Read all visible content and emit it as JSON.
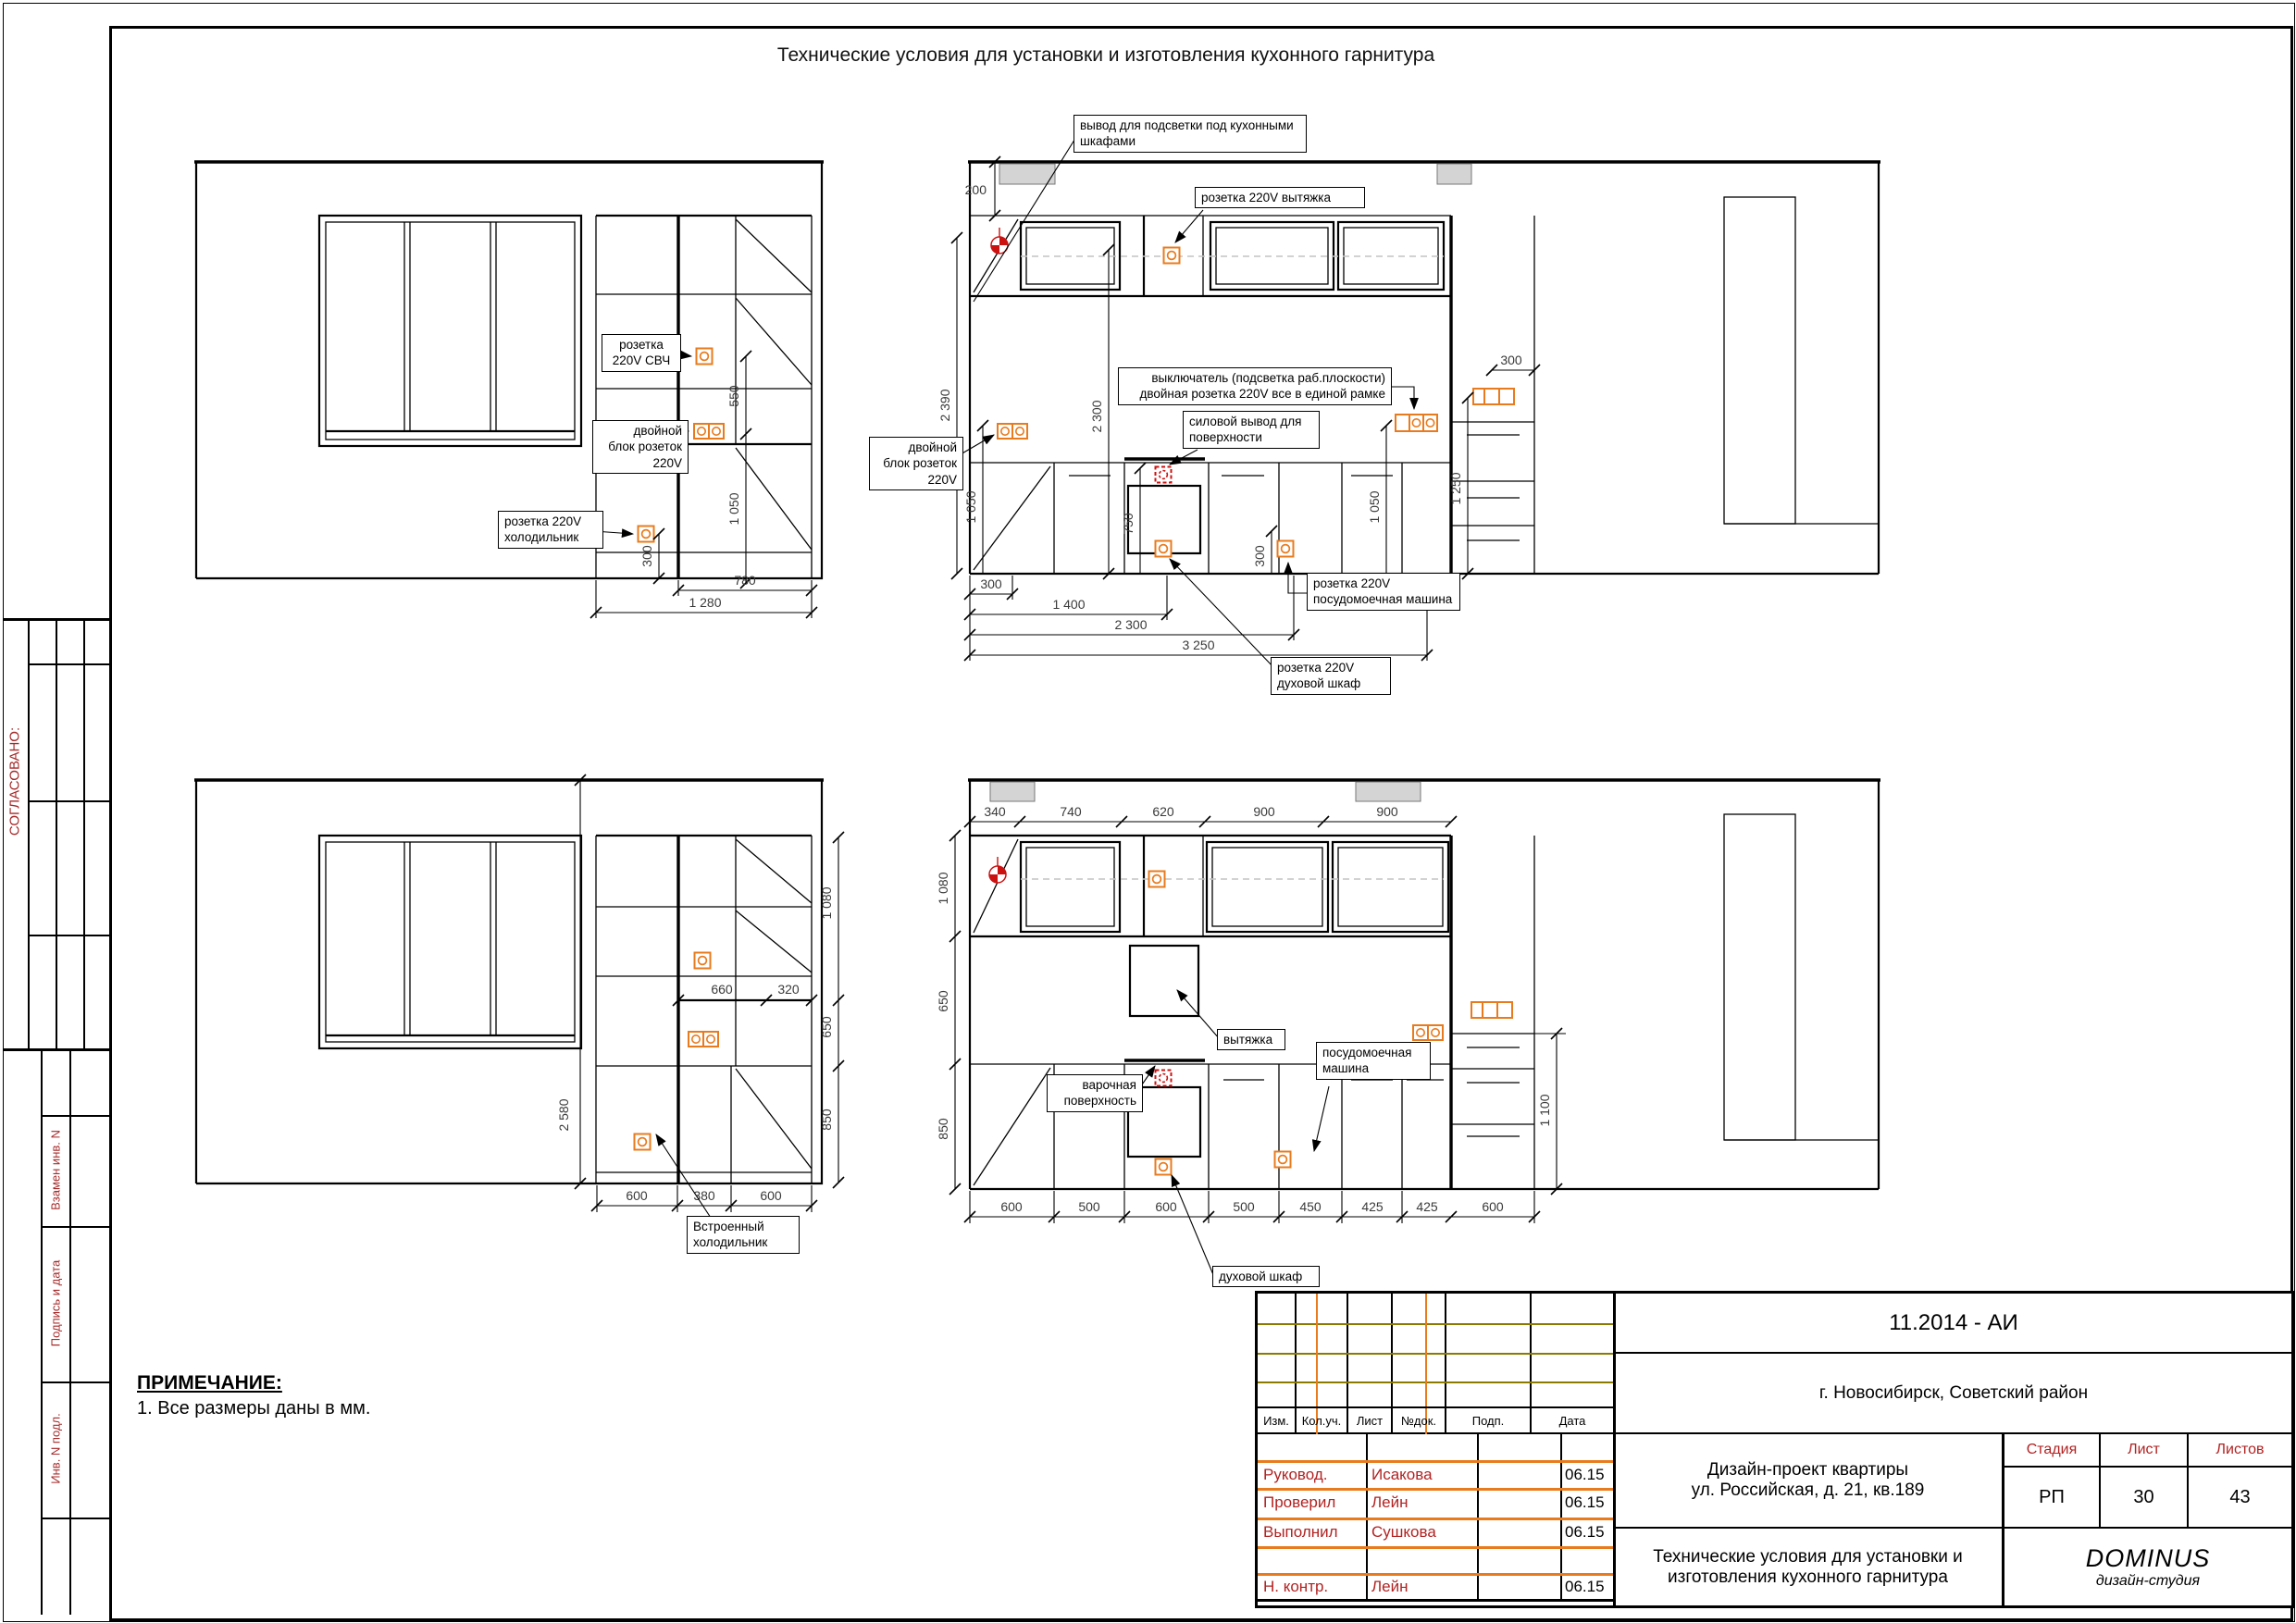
{
  "page": {
    "title": "Технические условия для установки и изготовления кухонного гарнитура",
    "note_title": "ПРИМЕЧАНИЕ:",
    "note_line": "1. Все размеры даны в мм."
  },
  "colors": {
    "accent_orange": "#e87b1e",
    "symbol_red": "#cc1111",
    "stamp_red": "#a52a2a",
    "olive_line": "#8a7a00",
    "beam_grey": "#d4d4d4"
  },
  "stamp": {
    "soglasovano": "СОГЛАСОВАНО:",
    "vzamen": "Взамен инв. N",
    "podpis": "Подпись и дата",
    "inv": "Инв. N подл."
  },
  "v1": {
    "callouts": {
      "svch": "розетка\n220V СВЧ",
      "dbl": "двойной\nблок розеток\n220V",
      "fridge": "розетка 220V\nхолодильник"
    },
    "dims": {
      "d550": "550",
      "d1050": "1 050",
      "d300": "300",
      "d780": "780",
      "d1280": "1 280"
    }
  },
  "v2": {
    "callouts": {
      "led": "вывод для подсветки под кухонными\nшкафами",
      "hood": "розетка 220V вытяжка",
      "switch": "выключатель (подсветка раб.плоскости)\nдвойная розетка 220V все в единой рамке",
      "power": "силовой вывод для\nповерхности",
      "dbl": "двойной\nблок розеток\n220V",
      "dw": "розетка 220V\nпосудомоечная машина",
      "oven": "розетка 220V\nдуховой шкаф"
    },
    "dims": {
      "top": "200",
      "h2390": "2 390",
      "h2300": "2 300",
      "h1050l": "1 050",
      "h750": "750",
      "h300dw": "300",
      "h1050r": "1 050",
      "top300": "300",
      "r1250": "1 250",
      "b300": "300",
      "b1400": "1 400",
      "b2300": "2 300",
      "b3250": "3 250"
    }
  },
  "v3": {
    "callouts": {
      "fridge": "Встроенный\nхолодильник"
    },
    "dims": {
      "r1080": "1 080",
      "r650": "650",
      "r850": "850",
      "t660": "660",
      "t320": "320",
      "l2580": "2 580",
      "b600a": "600",
      "b380": "380",
      "b600b": "600"
    }
  },
  "v4": {
    "callouts": {
      "hood": "вытяжка",
      "dw": "посудомоечная\nмашина",
      "cook": "варочная\nповерхность",
      "oven": "духовой шкаф"
    },
    "dims": {
      "t340": "340",
      "t740": "740",
      "t620": "620",
      "t900a": "900",
      "t900b": "900",
      "l1080": "1 080",
      "l650": "650",
      "l850": "850",
      "r1100": "1 100",
      "b600a": "600",
      "b500a": "500",
      "b600b": "600",
      "b500b": "500",
      "b450": "450",
      "b425a": "425",
      "b425b": "425",
      "b600c": "600"
    }
  },
  "tb": {
    "code": "11.2014 - АИ",
    "location": "г. Новосибирск, Советский район",
    "cols": {
      "izm": "Изм.",
      "kol": "Кол.уч.",
      "list": "Лист",
      "ndoc": "№док.",
      "podp": "Подп.",
      "data": "Дата"
    },
    "rows": [
      {
        "role": "Руковод.",
        "name": "Исакова",
        "date": "06.15"
      },
      {
        "role": "Проверил",
        "name": "Лейн",
        "date": "06.15"
      },
      {
        "role": "Выполнил",
        "name": "Сушкова",
        "date": "06.15"
      },
      {
        "role": "Н. контр.",
        "name": "Лейн",
        "date": "06.15"
      }
    ],
    "project": "Дизайн-проект квартиры\nул. Российская, д. 21, кв.189",
    "doc_title": "Технические условия для установки и\nизготовления кухонного гарнитура",
    "stage_label": "Стадия",
    "sheet_label": "Лист",
    "sheets_label": "Листов",
    "stage": "РП",
    "sheet": "30",
    "sheets": "43",
    "studio": "DOMINUS",
    "studio_sub": "дизайн-студия"
  }
}
